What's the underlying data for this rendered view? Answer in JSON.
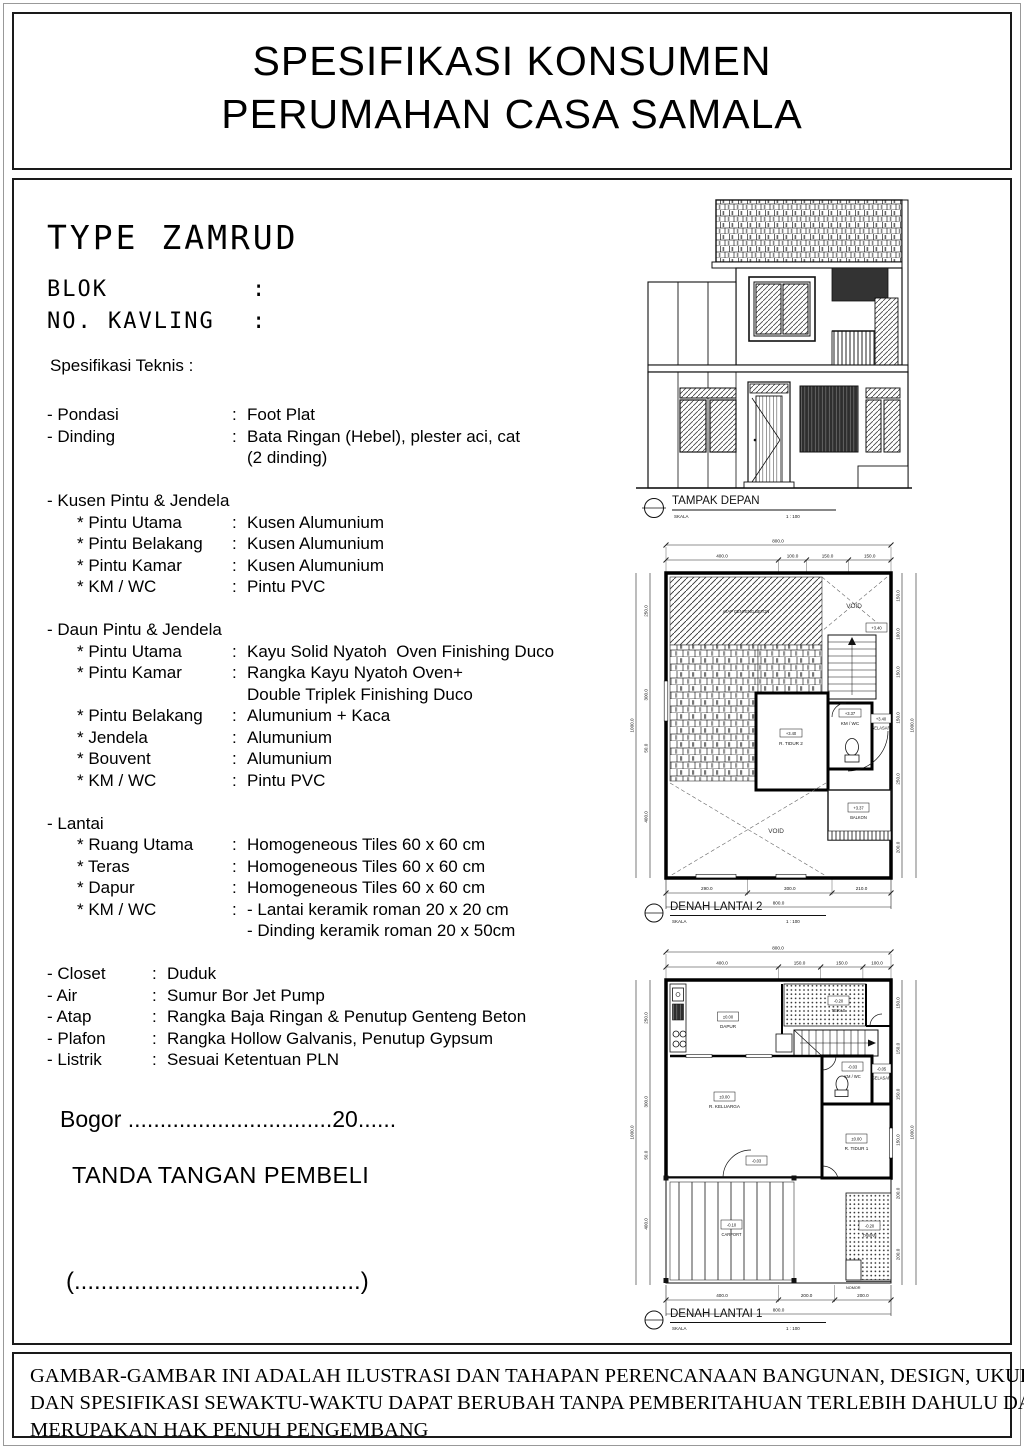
{
  "header": {
    "line1": "SPESIFIKASI KONSUMEN",
    "line2": "PERUMAHAN CASA SAMALA"
  },
  "info": {
    "type_title": "TYPE ZAMRUD",
    "blok_label": "BLOK",
    "kavling_label": "NO. KAVLING",
    "colon": ":",
    "spec_heading": "Spesifikasi Teknis :"
  },
  "specs": {
    "colon": ":",
    "pondasi": {
      "l": "- Pondasi",
      "v": "Foot Plat"
    },
    "dinding": {
      "l": "- Dinding",
      "v": "Bata Ringan (Hebel), plester aci, cat"
    },
    "dinding2": "(2 dinding)",
    "kusen_head": "- Kusen Pintu & Jendela",
    "kusen": [
      {
        "l": "* Pintu Utama",
        "v": "Kusen Alumunium"
      },
      {
        "l": "* Pintu Belakang",
        "v": "Kusen Alumunium"
      },
      {
        "l": "* Pintu Kamar",
        "v": "Kusen Alumunium"
      },
      {
        "l": "* KM / WC",
        "v": "Pintu PVC"
      }
    ],
    "daun_head": "- Daun Pintu & Jendela",
    "daun": [
      {
        "l": "* Pintu Utama",
        "v": "Kayu Solid Nyatoh  Oven Finishing Duco"
      },
      {
        "l": "* Pintu Kamar",
        "v": "Rangka Kayu Nyatoh Oven+"
      },
      {
        "cont": "Double Triplek Finishing Duco"
      },
      {
        "l": "* Pintu Belakang",
        "v": "Alumunium + Kaca"
      },
      {
        "l": "* Jendela",
        "v": "Alumunium"
      },
      {
        "l": "* Bouvent",
        "v": "Alumunium"
      },
      {
        "l": "* KM / WC",
        "v": "Pintu PVC"
      }
    ],
    "lantai_head": "- Lantai",
    "lantai": [
      {
        "l": "* Ruang Utama",
        "v": "Homogeneous Tiles 60 x 60 cm"
      },
      {
        "l": "* Teras",
        "v": "Homogeneous Tiles 60 x 60 cm"
      },
      {
        "l": "* Dapur",
        "v": "Homogeneous Tiles 60 x 60 cm"
      },
      {
        "l": "* KM / WC",
        "v": "- Lantai keramik roman 20 x 20 cm"
      },
      {
        "cont": "- Dinding keramik roman 20 x 50cm"
      }
    ],
    "misc": [
      {
        "l": "- Closet",
        "v": "Duduk"
      },
      {
        "l": "- Air",
        "v": "Sumur Bor Jet Pump"
      },
      {
        "l": "- Atap",
        "v": "Rangka Baja Ringan & Penutup Genteng Beton"
      },
      {
        "l": "- Plafon",
        "v": "Rangka Hollow Galvanis, Penutup Gypsum"
      },
      {
        "l": "- Listrik",
        "v": "Sesuai Ketentuan PLN"
      }
    ]
  },
  "signature": {
    "city_line": "Bogor ................................20......",
    "label": "TANDA TANGAN PEMBELI",
    "name_line": "(...........................................)"
  },
  "drawings": {
    "tampak": {
      "title": "TAMPAK DEPAN",
      "skala_label": "SKALA",
      "scale": "1 : 100"
    },
    "lantai2": {
      "title": "DENAH LANTAI 2",
      "skala_label": "SKALA",
      "scale": "1 : 100",
      "top_total": "800.0",
      "top_dims": [
        "400.0",
        "100.0",
        "150.0",
        "150.0"
      ],
      "bottom_dims": [
        "290.0",
        "300.0",
        "210.0"
      ],
      "bottom_total": "800.0",
      "left_dims": [
        "250.0",
        "300.0",
        "50.0",
        "400.0"
      ],
      "left_total": "1000.0",
      "right_dims": [
        "150.0",
        "100.0",
        "150.0",
        "150.0",
        "250.0",
        "200.0"
      ],
      "right_total": "1000.0",
      "rooms": {
        "void_top": "VOID",
        "void_bottom": "VOID",
        "atap": "ATAP GENTENG BETON",
        "landing_lvl": "+3.40",
        "tidur_lvl": "+3.40",
        "tidur": "R. TIDUR 2",
        "km_lvl": "+3.37",
        "km": "KM / WC",
        "selasar_lvl": "+3.40",
        "selasar": "SELASAR",
        "balkon_lvl": "+3.37",
        "balkon": "BALKON"
      }
    },
    "lantai1": {
      "title": "DENAH LANTAI 1",
      "skala_label": "SKALA",
      "scale": "1 : 100",
      "top_total": "800.0",
      "top_dims": [
        "400.0",
        "150.0",
        "150.0",
        "100.0"
      ],
      "bottom_dims": [
        "400.0",
        "200.0",
        "200.0"
      ],
      "bottom_total": "800.0",
      "left_dims": [
        "250.0",
        "300.0",
        "50.0",
        "400.0"
      ],
      "left_total": "1000.0",
      "right_dims": [
        "150.0",
        "150.0",
        "150.0",
        "150.0",
        "200.0",
        "200.0"
      ],
      "right_total": "1000.0",
      "rooms": {
        "dapur_lvl": "±0.00",
        "dapur": "DAPUR",
        "teras_lvl": "-0.20",
        "teras": "TERAS",
        "keluarga_lvl": "±0.00",
        "keluarga": "R. KELUARGA",
        "km_lvl": "-0.03",
        "km": "KM / WC",
        "selasar_lvl": "-0.05",
        "selasar": "SELASAR",
        "tidur_lvl": "±0.00",
        "tidur": "R. TIDUR 1",
        "carport_lvl": "-0.10",
        "carport": "CARPORT",
        "taman_lvl": "-0.20",
        "taman": "TAMAN",
        "back_lvl": "-0.03",
        "nomor": "NOMOR"
      }
    }
  },
  "footer": {
    "lines": [
      "GAMBAR-GAMBAR INI ADALAH ILUSTRASI DAN TAHAPAN PERENCANAAN BANGUNAN, DESIGN, UKURAN",
      "DAN SPESIFIKASI SEWAKTU-WAKTU DAPAT BERUBAH TANPA PEMBERITAHUAN TERLEBIH DAHULU DAN",
      "MERUPAKAN HAK PENUH PENGEMBANG"
    ]
  }
}
